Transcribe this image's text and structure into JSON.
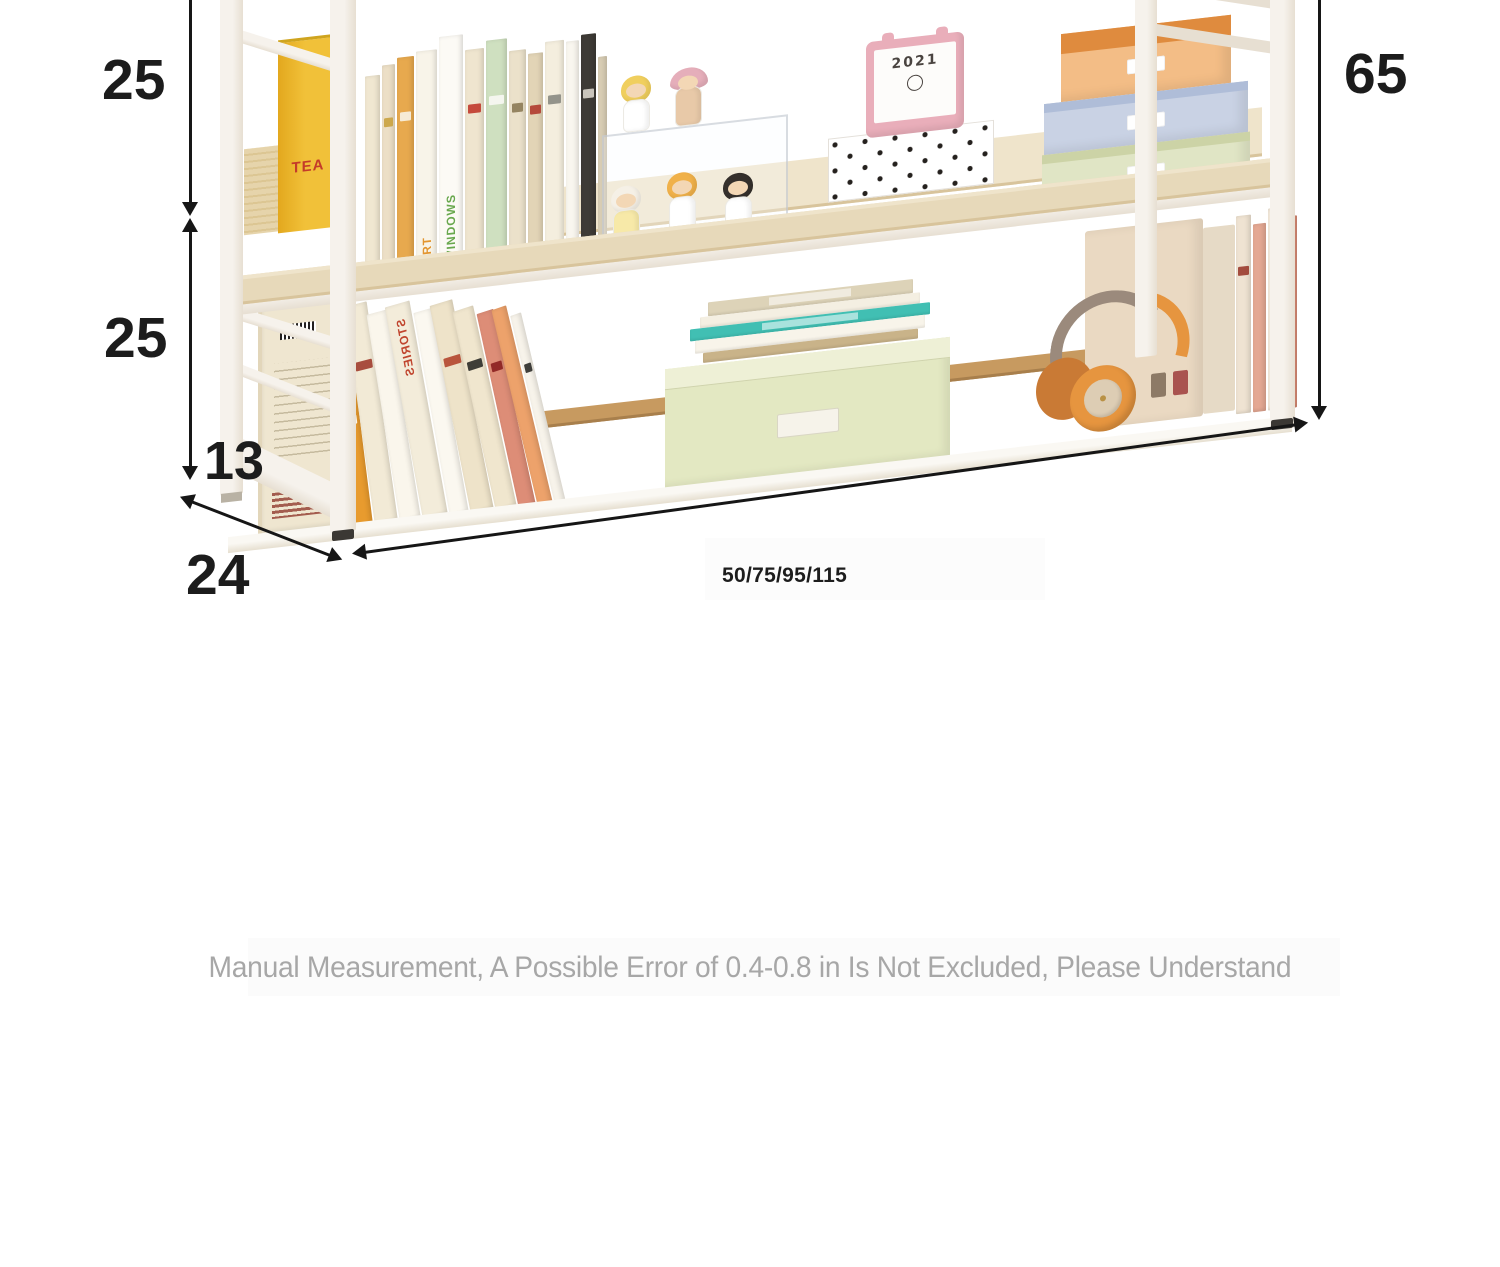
{
  "canvas": {
    "width": 1500,
    "height": 1267,
    "background": "#ffffff"
  },
  "annotations": {
    "shelf_gap_top": "25",
    "shelf_gap_middle": "25",
    "leg_height": "13",
    "depth": "24",
    "total_height": "65",
    "width_options": "50/75/95/115"
  },
  "disclaimer": "Manual Measurement, A Possible Error of 0.4-0.8 in Is Not Excluded, Please Understand",
  "decor": {
    "yellow_book_title": "TEA",
    "calendar_year": "2021"
  },
  "colors": {
    "frame": "#f6f2ec",
    "frame-shade": "#e7dfd2",
    "wood": "#e7d9ba",
    "wood-edge": "#d8c49c",
    "wood-light": "#efe4cb",
    "rail": "#c79a60",
    "arrow": "#161616",
    "dim-text": "#1c1c1c",
    "muted-text": "#a7a7a7",
    "yellow-book": "#f1c139",
    "yellow-book-deep": "#e3a81e",
    "tea-red": "#c43b2a",
    "teal": "#41bfb3",
    "green-box-front": "#e3e8c2",
    "green-box-top": "#eef0d6",
    "cream-box": "#ead9c2",
    "hp-orange": "#e6953f",
    "hp-band": "#9b8a7c",
    "skin": "#f3d7b5",
    "hat-pink": "#e9aeba"
  },
  "books_top": [
    {
      "c": "#f0e7d1",
      "w": 15,
      "h": 195
    },
    {
      "c": "#ecdfc6",
      "w": 13,
      "h": 204,
      "m": "#caa23f"
    },
    {
      "c": "#e7a94e",
      "w": 17,
      "h": 210,
      "m": "#f7f2e4"
    },
    {
      "c": "#f8f4e9",
      "w": 21,
      "h": 214,
      "t": "ART",
      "tc": "#e2952f"
    },
    {
      "c": "#fcfaf5",
      "w": 24,
      "h": 226,
      "t": "WINDOWS",
      "tc": "#69a84e"
    },
    {
      "c": "#efe5cf",
      "w": 19,
      "h": 210,
      "m": "#c0392b"
    },
    {
      "c": "#cfe0c0",
      "w": 21,
      "h": 217,
      "m": "#f8f8f4"
    },
    {
      "c": "#ebe1ca",
      "w": 17,
      "h": 204,
      "m": "#8c7a55"
    },
    {
      "c": "#e2d4b6",
      "w": 15,
      "h": 199,
      "m": "#b03a2e"
    },
    {
      "c": "#f4eede",
      "w": 19,
      "h": 209,
      "m": "#8a8a82"
    },
    {
      "c": "#f9f6ef",
      "w": 13,
      "h": 207
    },
    {
      "c": "#3e3b36",
      "w": 15,
      "h": 212,
      "m": "#d8d4ca"
    },
    {
      "c": "#d9ceb5",
      "w": 9,
      "h": 188
    }
  ],
  "books_bottom": [
    {
      "c": "#e89b2e",
      "w": 17,
      "h": 152,
      "r": 7,
      "m": "#ffffff"
    },
    {
      "c": "#f2ead6",
      "w": 23,
      "h": 224,
      "r": 8,
      "m": "#a03c2e"
    },
    {
      "c": "#faf6ec",
      "w": 21,
      "h": 214,
      "r": 9
    },
    {
      "c": "#f3ecda",
      "w": 25,
      "h": 220,
      "r": 10,
      "t": "STORIES",
      "tc": "#c0452e",
      "mir": true
    },
    {
      "c": "#fbf8f0",
      "w": 19,
      "h": 211,
      "r": 10
    },
    {
      "c": "#eee3c9",
      "w": 23,
      "h": 217,
      "r": 11,
      "m": "#b2452c"
    },
    {
      "c": "#f0e6ce",
      "w": 21,
      "h": 209,
      "r": 12,
      "m": "#2b2b28"
    },
    {
      "c": "#dd8d77",
      "w": 17,
      "h": 204,
      "r": 12,
      "m": "#8a1f1f"
    },
    {
      "c": "#eda26b",
      "w": 15,
      "h": 207,
      "r": 13
    },
    {
      "c": "#f7f3ea",
      "w": 11,
      "h": 199,
      "r": 13,
      "m": "#2b2b28"
    }
  ],
  "stack_layers": [
    {
      "c": "#ddd3b8",
      "h": 14,
      "w": 205,
      "patch": true
    },
    {
      "c": "#f4efe2",
      "h": 11,
      "w": 220
    },
    {
      "c": "#41bfb3",
      "h": 12,
      "w": 240,
      "patch": true
    },
    {
      "c": "#f8f4ea",
      "h": 13,
      "w": 230
    },
    {
      "c": "#c9b389",
      "h": 10,
      "w": 215
    }
  ],
  "right_boxes": [
    {
      "front": "#f3bd86",
      "side": "#df8b3e",
      "w": 170,
      "h": 48,
      "topH": 20
    },
    {
      "front": "#c9d2e4",
      "side": "#afbdd8",
      "w": 204,
      "h": 42,
      "topH": 9
    },
    {
      "front": "#e0e5c5",
      "side": "#ccd3a6",
      "w": 208,
      "h": 42,
      "topH": 9
    }
  ],
  "right_spines": [
    {
      "c": "#efe3d2",
      "w": 15,
      "h": 198,
      "m": "#9a3b2e"
    },
    {
      "c": "#e4a893",
      "w": 13,
      "h": 188
    },
    {
      "c": "#f2e8da",
      "w": 16,
      "h": 202,
      "m": "#7a3b2b"
    },
    {
      "c": "#d98b74",
      "w": 11,
      "h": 192
    }
  ],
  "figurines": [
    {
      "hair": "#f0cf5e",
      "body": "#ffffff"
    },
    {
      "hair": "#e5aeba",
      "body": "#e8c9a8"
    },
    {
      "hair": "#f5f0e6",
      "body": "#f7e9a8"
    },
    {
      "hair": "#f0b14a",
      "body": "#ffffff"
    },
    {
      "hair": "#35302c",
      "body": "#ffffff"
    }
  ]
}
